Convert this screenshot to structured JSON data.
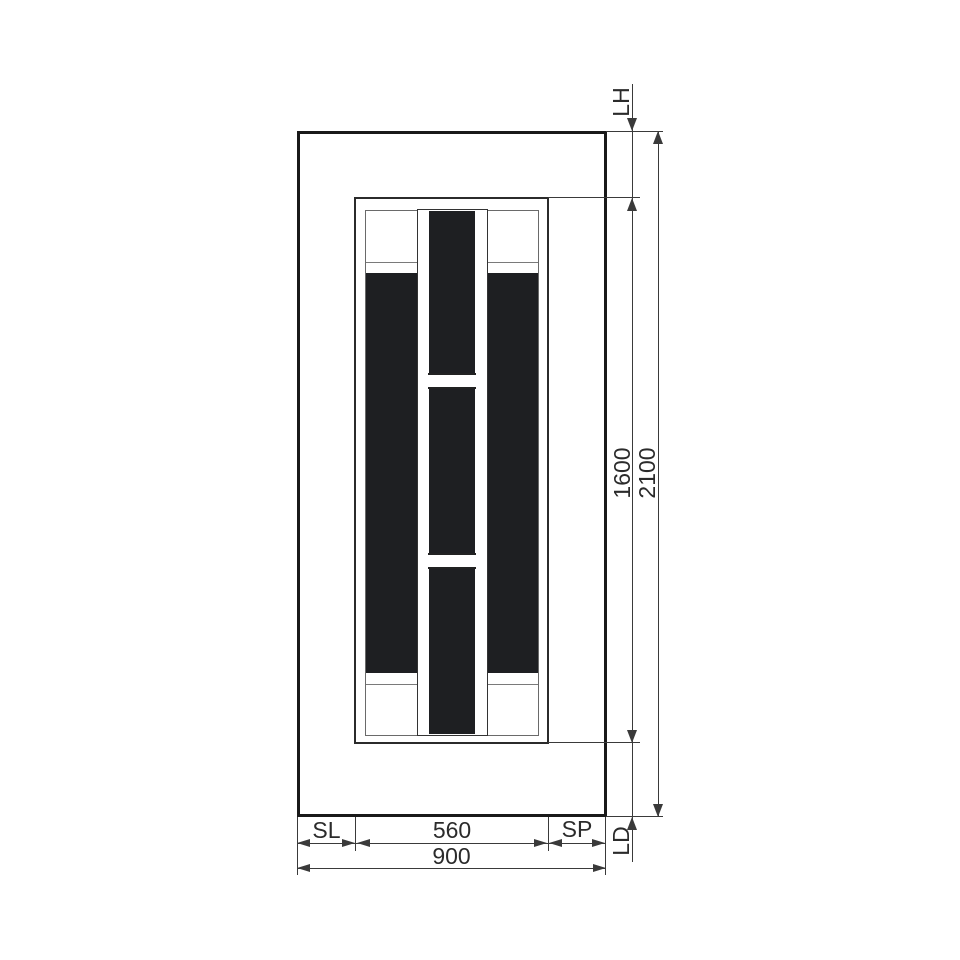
{
  "drawing": {
    "type": "door-technical-drawing",
    "labels": {
      "lh": "LH",
      "inner_height": "1600",
      "total_height": "2100",
      "sl": "SL",
      "inner_width": "560",
      "sp": "SP",
      "total_width": "900",
      "ld": "LD"
    },
    "colors": {
      "line": "#3a3a3a",
      "heavy_line": "#191919",
      "panel_fill": "#1e1f22",
      "background": "#ffffff"
    }
  }
}
